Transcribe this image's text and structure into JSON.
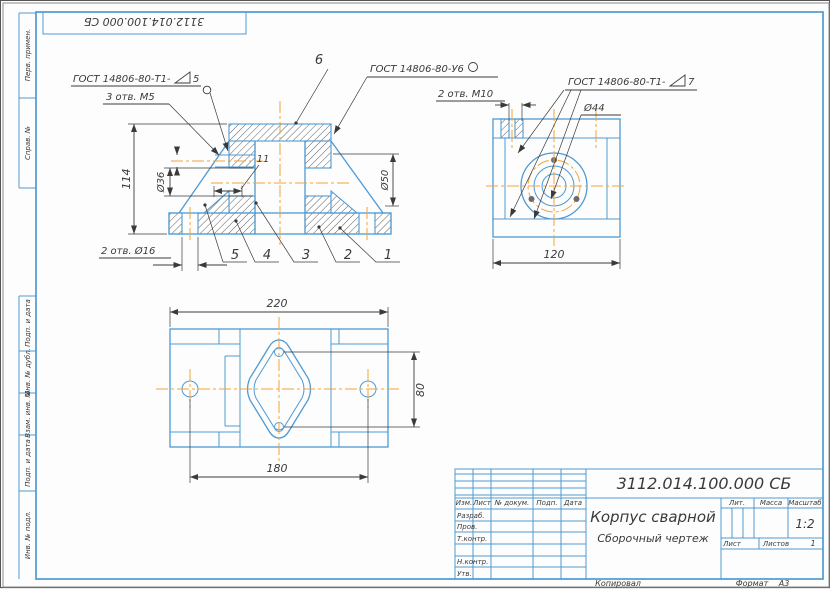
{
  "sheet": {
    "stamp_doc_number": "3112.014.100.000 СБ",
    "margin_labels": [
      "Перв. примен.",
      "Справ. №",
      "Подп. и дата",
      "Инв. № дубл.",
      "Взам. инв. №",
      "Подп. и дата",
      "Инв. № подл."
    ],
    "footer": {
      "copied": "Копировал",
      "format_label": "Формат",
      "format_value": "А3"
    }
  },
  "front_view": {
    "weld_note_left": {
      "prefix": "ГОСТ 14806-80-Т1-",
      "size": "5"
    },
    "weld_note_top": {
      "text": "ГОСТ 14806-80-У6"
    },
    "note_holes_m5": "3 отв. М5",
    "note_holes_d16": "2 отв. Ø16",
    "dim_height": "114",
    "dim_bore": "Ø36",
    "dim_boss": "Ø50",
    "dim_rib": "11",
    "balloons": [
      "1",
      "2",
      "3",
      "4",
      "5",
      "6"
    ]
  },
  "side_view": {
    "weld_note_right": {
      "prefix": "ГОСТ 14806-80-Т1-",
      "size": "7"
    },
    "note_holes_m10": "2 отв. М10",
    "dim_bolt_circle": "Ø44",
    "dim_width": "120"
  },
  "top_view": {
    "dim_length": "220",
    "dim_span": "180",
    "dim_depth": "80"
  },
  "title_block": {
    "doc_number": "3112.014.100.000 СБ",
    "part_name": "Корпус сварной",
    "doc_type": "Сборочный чертеж",
    "headers": {
      "lit": "Лит.",
      "mass": "Масса",
      "scale": "Масштаб"
    },
    "scale_value": "1:2",
    "sheet_row": {
      "sheet": "Лист",
      "sheets": "Листов",
      "sheets_value": "1"
    },
    "columns": {
      "izm": "Изм.",
      "list": "Лист",
      "doc": "№ докум.",
      "sign": "Подп.",
      "date": "Дата"
    },
    "rows": [
      "Разраб.",
      "Пров.",
      "Т.контр.",
      "Н.контр.",
      "Утв."
    ]
  },
  "colors": {
    "line_blue": "#4e9ad3",
    "centerline_orange": "#f2a23c",
    "ink": "#3a3a3a"
  }
}
